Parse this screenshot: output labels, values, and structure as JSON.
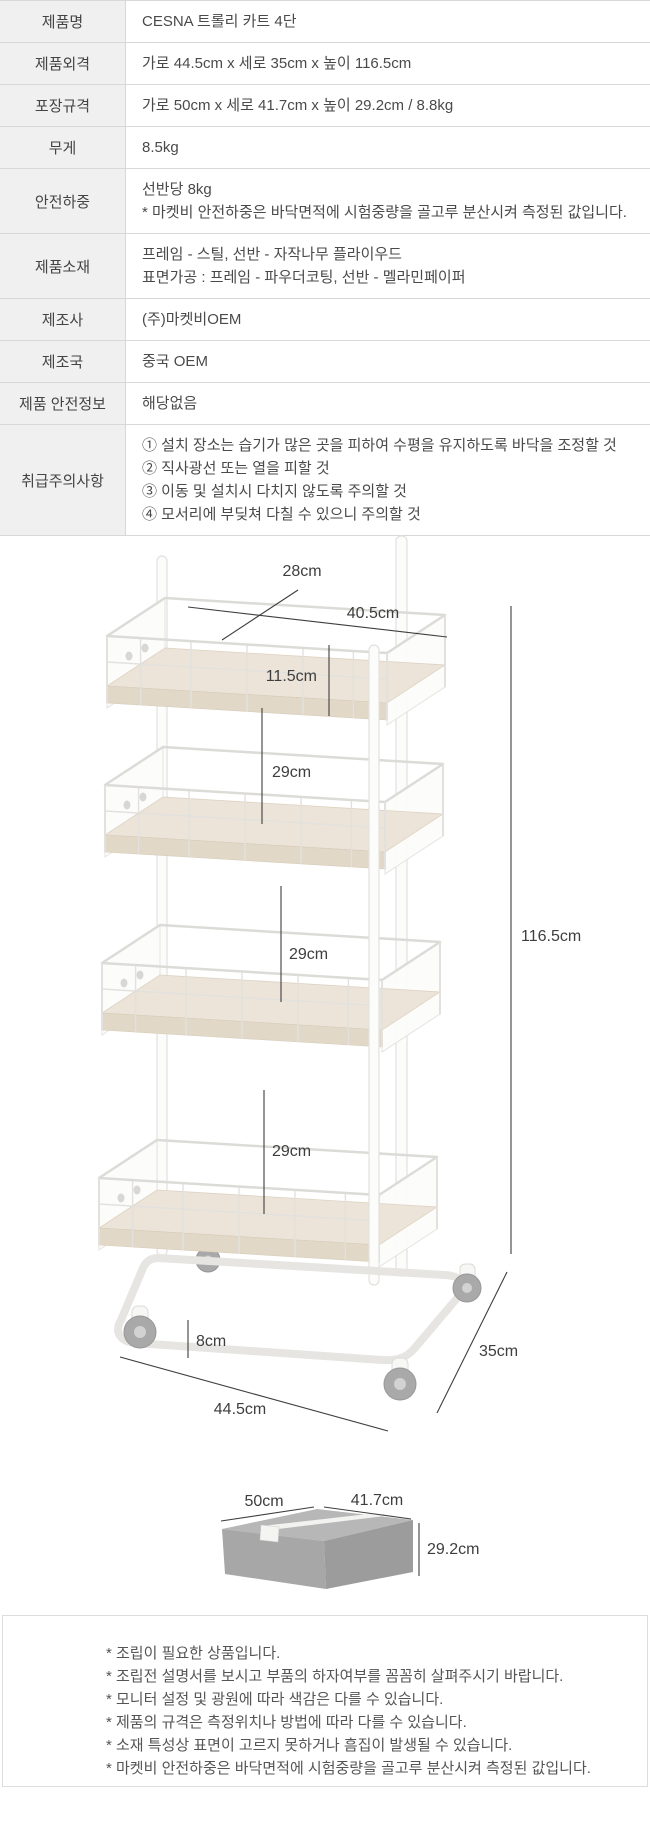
{
  "colors": {
    "label_cell_bg": "#f0f0f0",
    "table_border": "#d8d8d8",
    "text": "#4a4a4a",
    "dimension_line": "#3e3e3e",
    "wood_shelf": "#ece4d8",
    "cart_frame": "#e2e1de",
    "box_top": "#b7b7b7",
    "box_left": "#a7a7a7",
    "box_right": "#9c9c9c",
    "wheel": "#a9a9a9"
  },
  "spec_table": {
    "rows": [
      {
        "label": "제품명",
        "lines": [
          "CESNA 트롤리 카트 4단"
        ]
      },
      {
        "label": "제품외격",
        "lines": [
          "가로 44.5cm x 세로 35cm x 높이 116.5cm"
        ]
      },
      {
        "label": "포장규격",
        "lines": [
          "가로 50cm x 세로 41.7cm x 높이 29.2cm / 8.8kg"
        ]
      },
      {
        "label": "무게",
        "lines": [
          "8.5kg"
        ]
      },
      {
        "label": "안전하중",
        "lines": [
          "선반당 8kg",
          "* 마켓비 안전하중은 바닥면적에 시험중량을 골고루 분산시켜 측정된 값입니다."
        ]
      },
      {
        "label": "제품소재",
        "lines": [
          "프레임 - 스틸, 선반 - 자작나무 플라이우드",
          "표면가공 : 프레임 - 파우더코팅, 선반 - 멜라민페이퍼"
        ]
      },
      {
        "label": "제조사",
        "lines": [
          "(주)마켓비OEM"
        ]
      },
      {
        "label": "제조국",
        "lines": [
          "중국 OEM"
        ]
      },
      {
        "label": "제품 안전정보",
        "lines": [
          "해당없음"
        ]
      },
      {
        "label": "취급주의사항",
        "lines": [
          "① 설치 장소는 습기가 많은 곳을 피하여 수평을 유지하도록 바닥을 조정할 것",
          "② 직사광선 또는 열을 피할 것",
          "③ 이동 및 설치시 다치지 않도록 주의할 것",
          "④ 모서리에 부딪쳐 다칠 수 있으니 주의할 것"
        ]
      }
    ]
  },
  "cart_diagram": {
    "labels": {
      "top_depth": "28cm",
      "top_width": "40.5cm",
      "basket_height": "11.5cm",
      "shelf_gap_1": "29cm",
      "shelf_gap_2": "29cm",
      "shelf_gap_3": "29cm",
      "caster_height": "8cm",
      "overall_width": "44.5cm",
      "overall_depth": "35cm",
      "overall_height": "116.5cm"
    }
  },
  "box_diagram": {
    "labels": {
      "width": "50cm",
      "depth": "41.7cm",
      "height": "29.2cm"
    }
  },
  "footnotes": {
    "lines": [
      "* 조립이 필요한 상품입니다.",
      "* 조립전 설명서를 보시고 부품의 하자여부를 꼼꼼히 살펴주시기 바랍니다.",
      "* 모니터 설정 및 광원에 따라 색감은 다를 수 있습니다.",
      "* 제품의 규격은 측정위치나 방법에 따라 다를 수 있습니다.",
      "* 소재 특성상 표면이 고르지 못하거나 흠집이 발생될 수 있습니다.",
      "* 마켓비 안전하중은 바닥면적에 시험중량을 골고루 분산시켜 측정된 값입니다."
    ]
  }
}
